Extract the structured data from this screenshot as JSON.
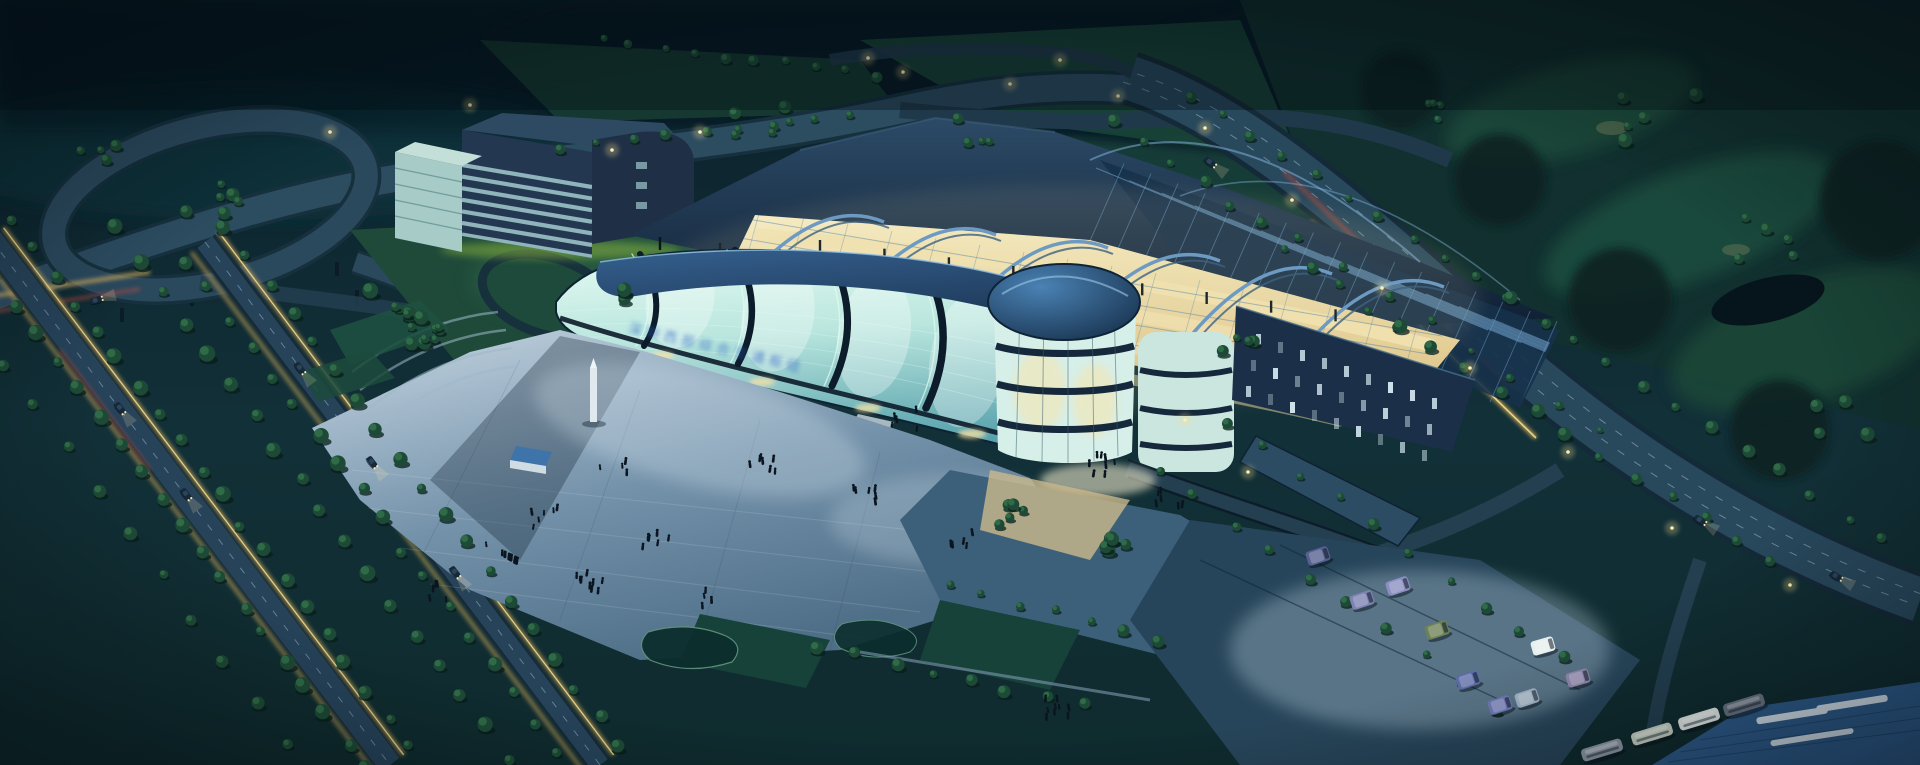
{
  "meta": {
    "type": "architectural-aerial-rendering",
    "time_of_day": "dusk",
    "description": "Night aerial rendering of a curved glass transport-hub building with arched open steel roof and warm lit concourse, navy office slab, highway interchange at upper left, tree-lined boulevards with light trails, forested hills and golf course behind, front plaza with pedestrians, van parking lot and bus canopy at lower right."
  },
  "signage": {
    "glass_text": "深圳西部综合交通枢纽"
  },
  "palette": {
    "bg": "#0a1f29",
    "hills": "#0e2831",
    "golf": "#1d4a3a",
    "pond": "#06141c",
    "road": "#28485c",
    "road_casing": "#142a38",
    "lane": "#a9c6d6",
    "warm_strip": "#c9a552",
    "warm_core": "#f0d88e",
    "red_streak": "#ae493e",
    "glass_hi": "#e6fbf2",
    "glass_mid": "#b9e6de",
    "glass_deep": "#58a2ad",
    "mullion": "#0c1c2a",
    "roof_band": "#1d3a5c",
    "ridge": "#16293f",
    "steel": "#5e93c6",
    "warm_floor": "#f1e2b1",
    "dome": "#1c4a78",
    "slab": "#223850",
    "slab_band": "#8fb4bb",
    "plaza": "#7e9ab0",
    "canopy": "#2e5c8c",
    "tree": "#1d4a36",
    "lawn": "#1f4a3a",
    "lamp": "#ffeeb0",
    "signage_blue": "#2f62c8"
  },
  "scene": {
    "tree_rows": [
      [
        -28,
        252,
        368,
        772,
        20,
        1
      ],
      [
        12,
        222,
        410,
        748,
        20,
        1
      ],
      [
        118,
        232,
        505,
        760,
        18,
        1.05
      ],
      [
        186,
        262,
        580,
        782,
        19,
        1
      ],
      [
        226,
        226,
        620,
        748,
        19,
        1
      ],
      [
        -60,
        280,
        320,
        790,
        13,
        0.85
      ],
      [
        1118,
        122,
        1398,
        330,
        11,
        0.8
      ],
      [
        1398,
        330,
        1772,
        562,
        12,
        0.9
      ],
      [
        1188,
        96,
        1508,
        300,
        11,
        0.75
      ],
      [
        1508,
        300,
        1880,
        540,
        12,
        0.85
      ],
      [
        1300,
        242,
        1600,
        432,
        8,
        0.6
      ],
      [
        1228,
        422,
        1560,
        660,
        10,
        0.8
      ],
      [
        1158,
        472,
        1500,
        712,
        10,
        0.8
      ],
      [
        820,
        648,
        1082,
        708,
        8,
        0.85
      ],
      [
        600,
        42,
        880,
        76,
        10,
        0.7
      ],
      [
        560,
        150,
        850,
        116,
        9,
        0.7
      ],
      [
        948,
        588,
        1160,
        640,
        7,
        0.8
      ]
    ],
    "tree_clusters": [
      [
        392,
        306,
        6,
        55,
        1.0
      ],
      [
        430,
        336,
        4,
        40,
        0.9
      ],
      [
        210,
        206,
        6,
        70,
        0.85
      ],
      [
        95,
        152,
        4,
        46,
        0.8
      ],
      [
        628,
        300,
        3,
        30,
        0.9
      ],
      [
        1016,
        516,
        5,
        34,
        0.9
      ],
      [
        1112,
        546,
        5,
        34,
        0.9
      ],
      [
        422,
        330,
        5,
        44,
        0.9
      ],
      [
        1240,
        350,
        4,
        40,
        0.8
      ],
      [
        760,
        120,
        5,
        60,
        0.8
      ],
      [
        980,
        130,
        4,
        50,
        0.75
      ],
      [
        1660,
        120,
        5,
        80,
        0.9
      ],
      [
        1760,
        240,
        5,
        70,
        0.9
      ],
      [
        1840,
        420,
        4,
        60,
        0.9
      ],
      [
        1430,
        120,
        4,
        60,
        0.8
      ]
    ],
    "lamps": [
      [
        903,
        72
      ],
      [
        1010,
        84
      ],
      [
        1118,
        96
      ],
      [
        1205,
        128
      ],
      [
        1292,
        200
      ],
      [
        1382,
        288
      ],
      [
        1470,
        368
      ],
      [
        1568,
        452
      ],
      [
        1672,
        528
      ],
      [
        1790,
        585
      ],
      [
        612,
        150
      ],
      [
        700,
        132
      ],
      [
        470,
        105
      ],
      [
        330,
        132
      ],
      [
        1185,
        420
      ],
      [
        1248,
        472
      ],
      [
        868,
        58
      ],
      [
        1060,
        60
      ]
    ],
    "people_clusters": [
      [
        500,
        555,
        12
      ],
      [
        590,
        585,
        9
      ],
      [
        655,
        545,
        6
      ],
      [
        762,
        470,
        7
      ],
      [
        862,
        500,
        6
      ],
      [
        962,
        545,
        5
      ],
      [
        1105,
        468,
        8
      ],
      [
        1168,
        500,
        6
      ],
      [
        1062,
        712,
        9
      ],
      [
        438,
        596,
        5
      ],
      [
        702,
        600,
        4
      ],
      [
        906,
        422,
        5
      ],
      [
        545,
        520,
        6
      ],
      [
        615,
        470,
        4
      ]
    ],
    "vans": [
      [
        1362,
        600,
        -18,
        "#7d82b2"
      ],
      [
        1398,
        586,
        -18,
        "#8a8fc0"
      ],
      [
        1437,
        630,
        -18,
        "#6d8157"
      ],
      [
        1543,
        646,
        -16,
        "#e6efee"
      ],
      [
        1578,
        678,
        -16,
        "#8f86ae"
      ],
      [
        1468,
        680,
        -18,
        "#5c6ba4"
      ],
      [
        1500,
        705,
        -18,
        "#6f79b5"
      ],
      [
        1527,
        698,
        -18,
        "#9fb3c6"
      ],
      [
        1318,
        556,
        -18,
        "#55608f"
      ]
    ],
    "buses": [
      [
        1652,
        734,
        -17,
        "#c9d4c8"
      ],
      [
        1699,
        719,
        -17,
        "#e4ecea"
      ],
      [
        1744,
        705,
        -17,
        "#6a7686"
      ],
      [
        1602,
        750,
        -17,
        "#8e9aa8"
      ]
    ],
    "cars": [
      [
        120,
        408,
        53
      ],
      [
        186,
        494,
        53
      ],
      [
        300,
        368,
        53
      ],
      [
        372,
        462,
        53
      ],
      [
        455,
        572,
        53
      ],
      [
        96,
        300,
        -15
      ],
      [
        1210,
        162,
        38
      ],
      [
        1700,
        520,
        33
      ],
      [
        1836,
        576,
        30
      ]
    ],
    "line_sets": [
      {
        "x": 1096,
        "y": 168,
        "sx": 33,
        "sy": 12.6,
        "dx": 392,
        "dy": 162,
        "n": 13,
        "stroke": "#6fa0c9",
        "w": 1,
        "op": 0.6,
        "clip": "latticeClip",
        "into": "g-lines-lattice"
      },
      {
        "x": 1130,
        "y": 150,
        "sx": 27,
        "sy": 10,
        "dx": -52,
        "dy": 118,
        "n": 18,
        "stroke": "#6fa0c9",
        "w": 0.9,
        "op": 0.5,
        "clip": "latticeClip",
        "into": "g-lines-lattice"
      },
      {
        "x": 742,
        "y": 218,
        "sx": -8,
        "sy": 19,
        "dx": 700,
        "dy": 118,
        "n": 7,
        "stroke": "#4b7ca8",
        "w": 1,
        "op": 0.5,
        "clip": "concClip",
        "into": "g-lines-conc"
      },
      {
        "x": 760,
        "y": 210,
        "sx": 44,
        "sy": 7,
        "dx": -36,
        "dy": 130,
        "n": 16,
        "stroke": "#4b7ca8",
        "w": 0.8,
        "op": 0.4,
        "clip": "concClip",
        "into": "g-lines-conc"
      }
    ],
    "posts": [
      [
        770,
        300,
        1340,
        372,
        10,
        14
      ],
      [
        820,
        252,
        1400,
        330,
        10,
        12
      ],
      [
        660,
        250,
        1080,
        292,
        8,
        13
      ]
    ],
    "wing_windows": {
      "x": 1256,
      "y": 334,
      "cols": 9,
      "rows": 3,
      "dcx": 22,
      "dcy": 8,
      "drx": -5,
      "dry": 26,
      "w": 5,
      "h": 11,
      "fill": "#d9ecf5"
    }
  }
}
